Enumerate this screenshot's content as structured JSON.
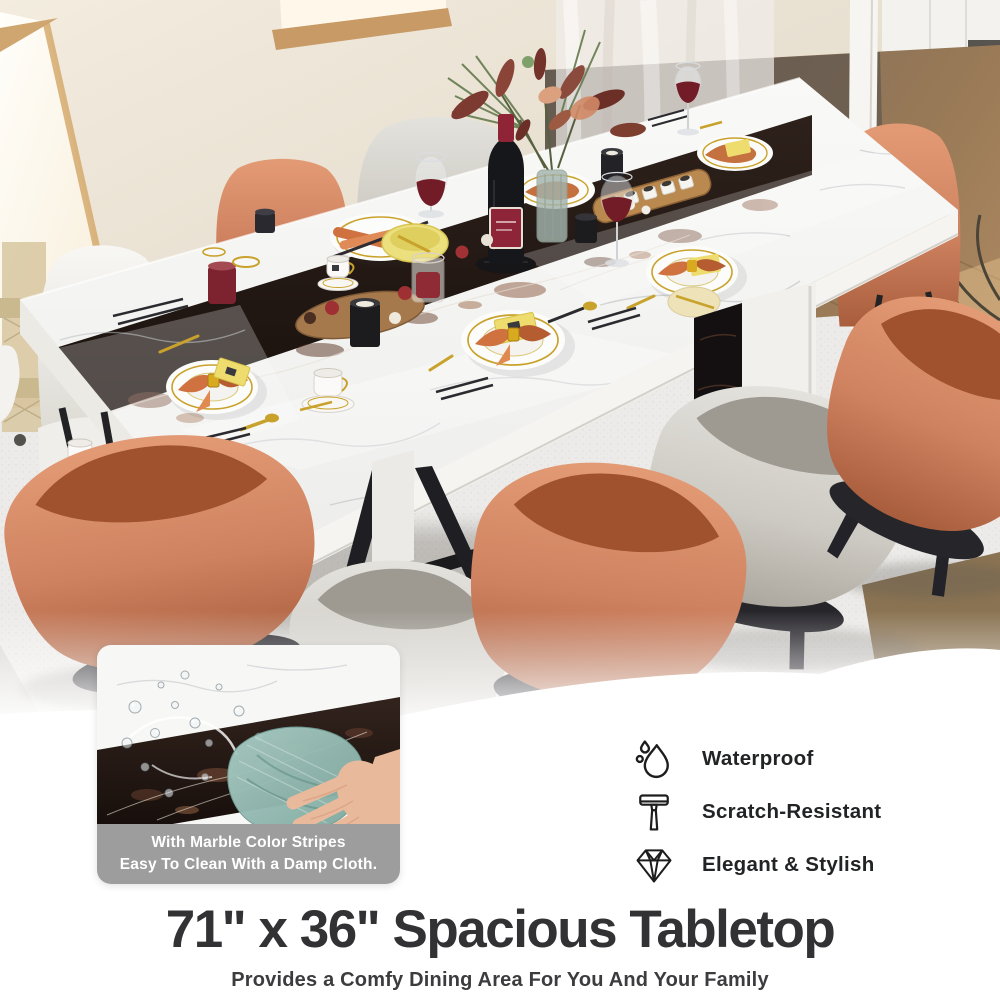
{
  "headline": {
    "title": "71\" x 36\" Spacious Tabletop",
    "subtitle": "Provides a Comfy Dining Area For You And Your Family"
  },
  "inset": {
    "caption_line1": "With Marble Color Stripes",
    "caption_line2": "Easy To Clean With a Damp Cloth.",
    "caption_bg": "#9d9d9d"
  },
  "features": {
    "items": [
      {
        "icon": "water-drop-icon",
        "label": "Waterproof"
      },
      {
        "icon": "razor-icon",
        "label": "Scratch-Resistant"
      },
      {
        "icon": "diamond-icon",
        "label": "Elegant & Stylish"
      }
    ]
  },
  "photo": {
    "subject": "marble dining table set for dinner with orange and gray chairs",
    "palette": {
      "chair_orange": "#cd8160",
      "chair_gray": "#d5d2cc",
      "marble_white": "#f7f7f5",
      "marble_runner_dark": "#221713",
      "napkin_orange": "#c96f3f",
      "gold_accent": "#c9a22b",
      "red_wine": "#731c28",
      "cleaning_cloth_teal": "#93bcb2",
      "wood_floor": "#a9815a",
      "rug": "#e9e8e5",
      "wall": "#e7dfd2",
      "text_dark": "#323234"
    }
  }
}
